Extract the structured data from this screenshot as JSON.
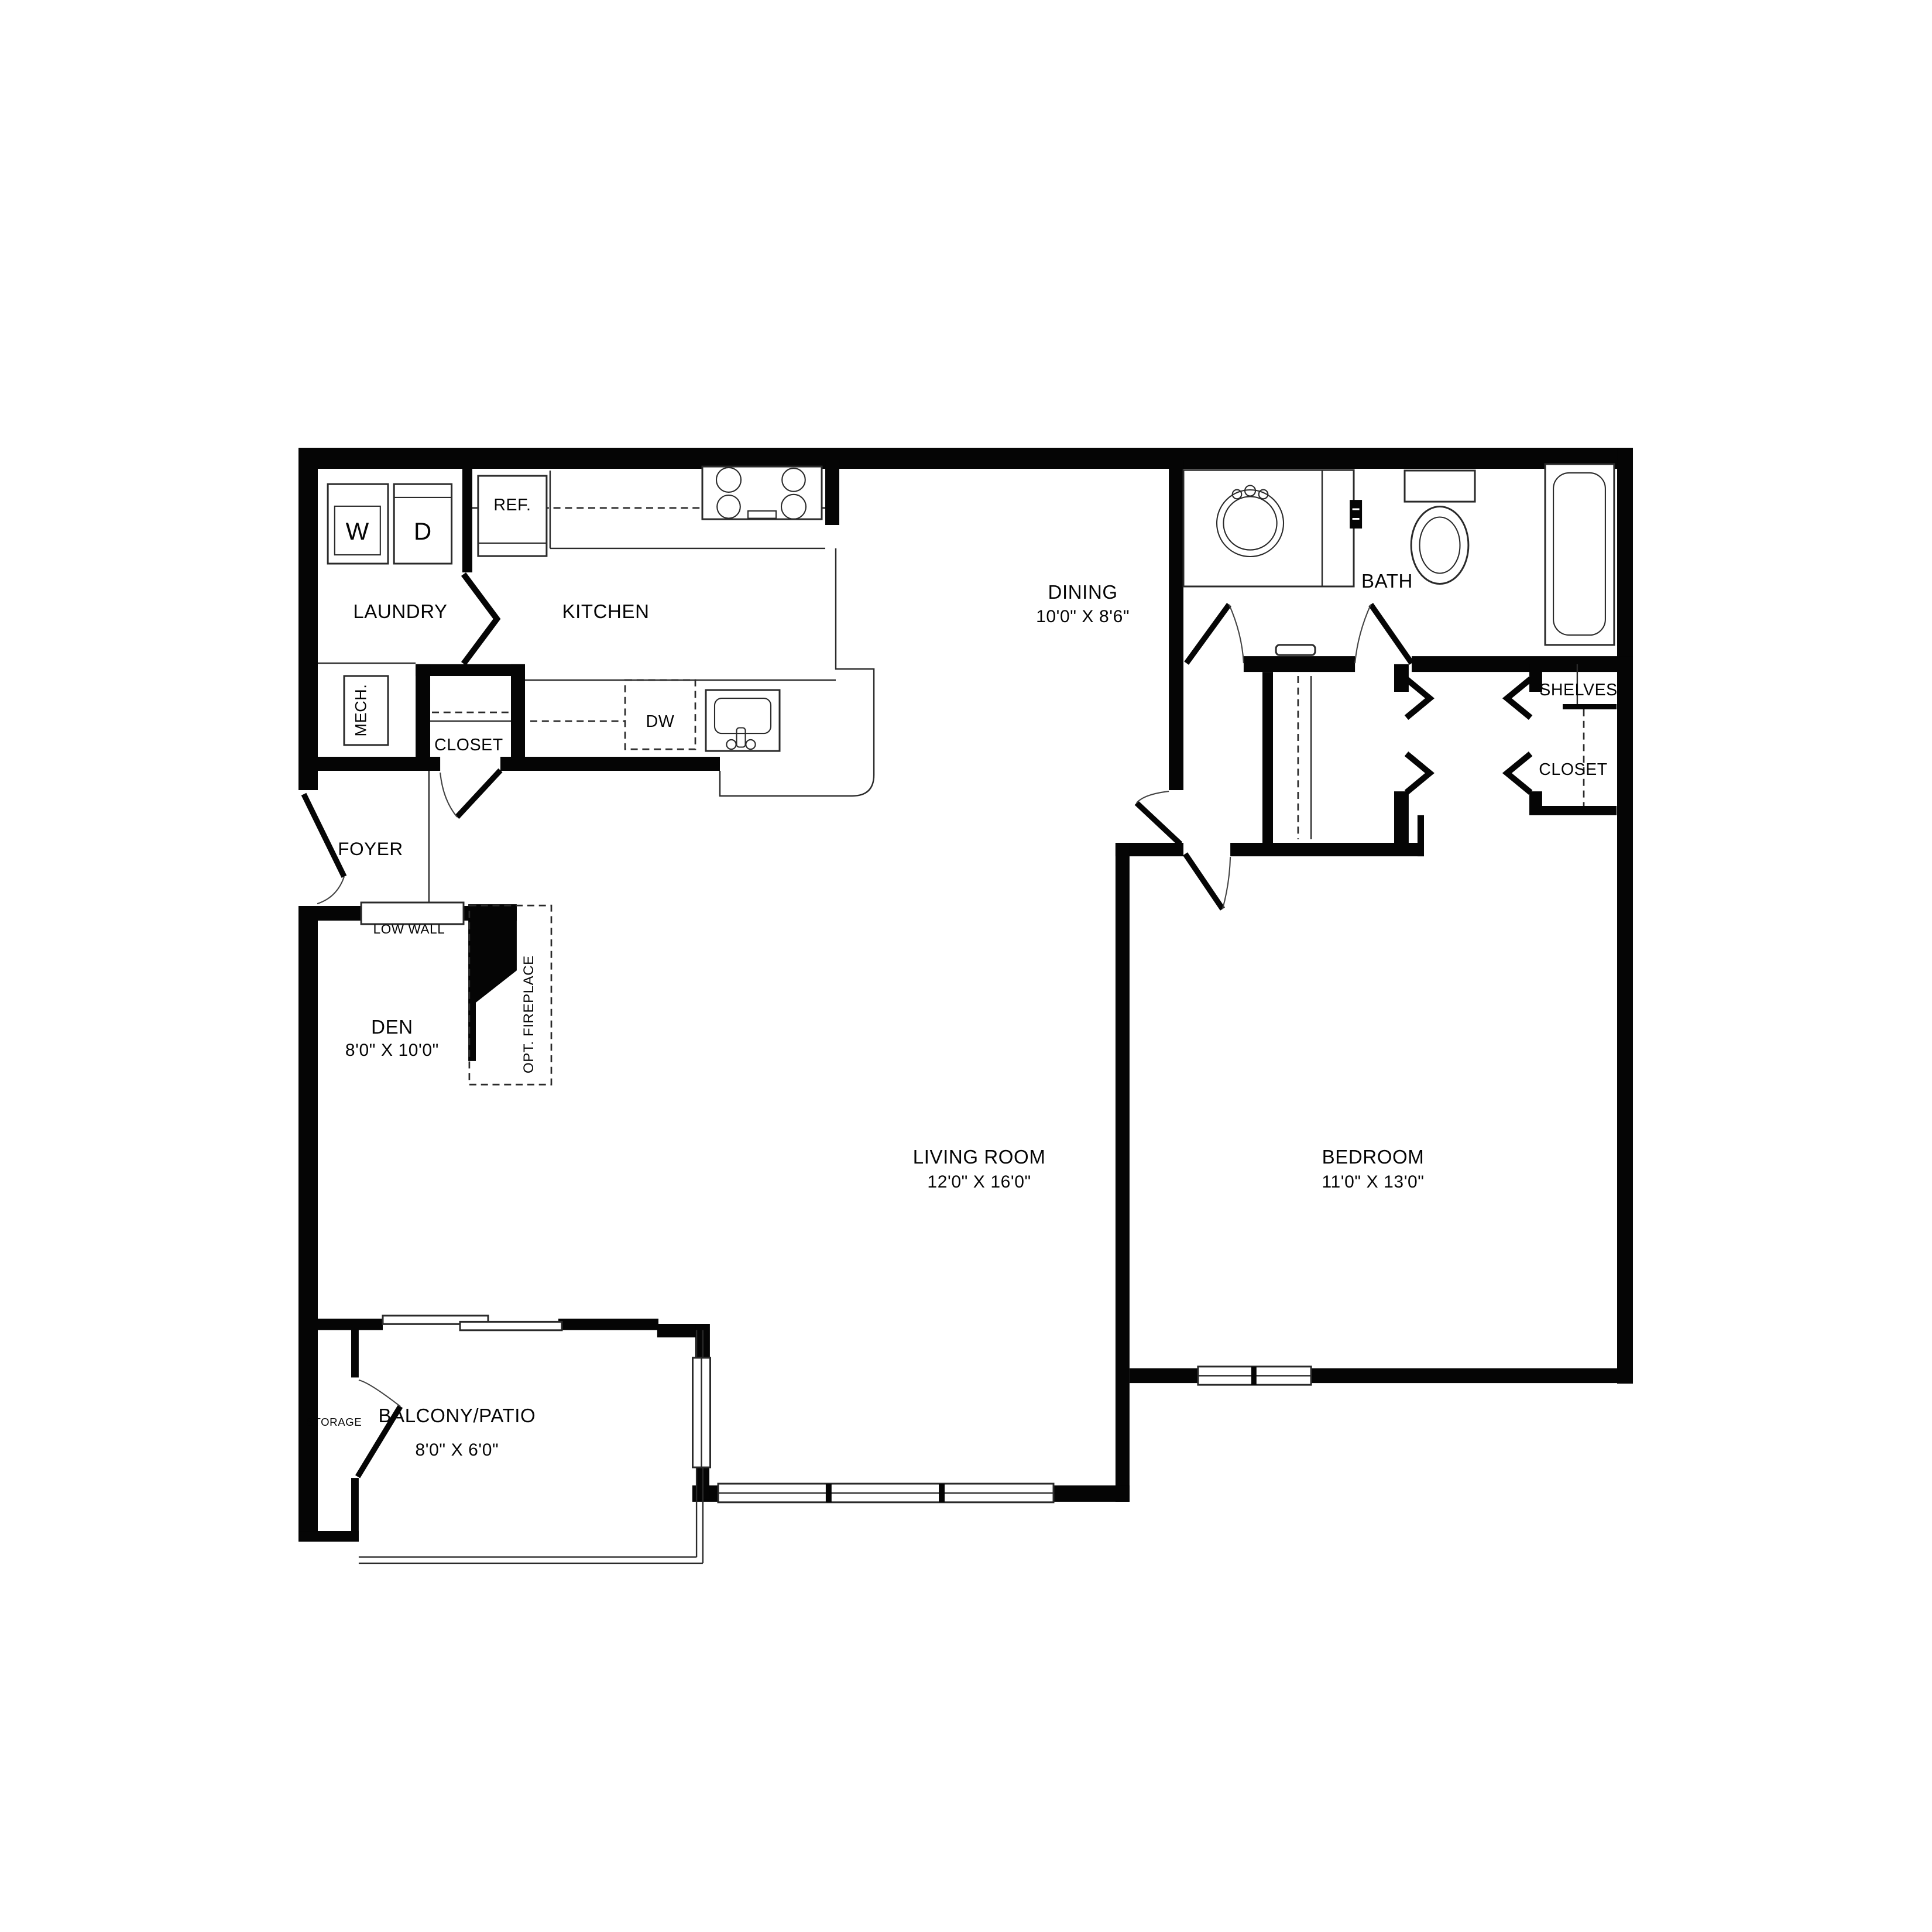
{
  "rooms": {
    "laundry": {
      "label": "LAUNDRY"
    },
    "kitchen": {
      "label": "KITCHEN"
    },
    "dining": {
      "label": "DINING",
      "dims": "10'0\" X 8'6\""
    },
    "bath": {
      "label": "BATH"
    },
    "foyer": {
      "label": "FOYER"
    },
    "den": {
      "label": "DEN",
      "dims": "8'0\" X 10'0\""
    },
    "living_room": {
      "label": "LIVING ROOM",
      "dims": "12'0\" X 16'0\""
    },
    "bedroom": {
      "label": "BEDROOM",
      "dims": "11'0\" X 13'0\""
    },
    "storage": {
      "label": "STORAGE"
    },
    "balcony": {
      "label": "BALCONY/PATIO",
      "dims": "8'0\" X 6'0\""
    }
  },
  "features": {
    "mech": {
      "label": "MECH."
    },
    "entry_closet": {
      "label": "CLOSET"
    },
    "bedroom_closet": {
      "label": "CLOSET"
    },
    "shelves": {
      "label": "SHELVES"
    },
    "low_wall": {
      "label": "LOW WALL"
    },
    "opt_fireplace": {
      "label": "OPT. FIREPLACE"
    }
  },
  "appliances": {
    "washer": {
      "label": "W"
    },
    "dryer": {
      "label": "D"
    },
    "refrigerator": {
      "label": "REF."
    },
    "dishwasher": {
      "label": "DW"
    }
  },
  "colors": {
    "wall": "#050505",
    "background": "#ffffff"
  }
}
